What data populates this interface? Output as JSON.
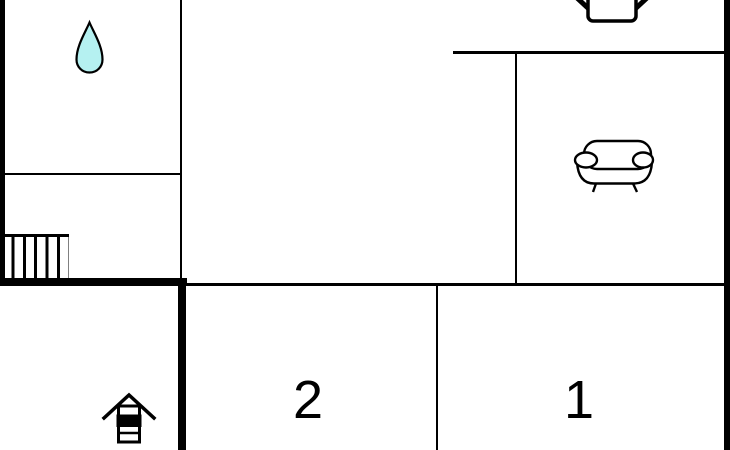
{
  "floorplan": {
    "background_color": "#ffffff",
    "wall_color": "#000000",
    "rooms": {
      "bedroom2": {
        "label": "2"
      },
      "bedroom1": {
        "label": "1"
      }
    },
    "icons": {
      "water_drop": {
        "name": "water-drop-icon",
        "fill": "#b5f1f1",
        "outline": "#000000"
      },
      "chair": {
        "name": "chair-icon",
        "outline": "#000000"
      },
      "sofa": {
        "name": "sofa-icon",
        "outline": "#000000"
      },
      "stairs": {
        "name": "stairs-icon",
        "outline": "#000000"
      },
      "well": {
        "name": "well-icon",
        "outline": "#000000"
      }
    }
  }
}
